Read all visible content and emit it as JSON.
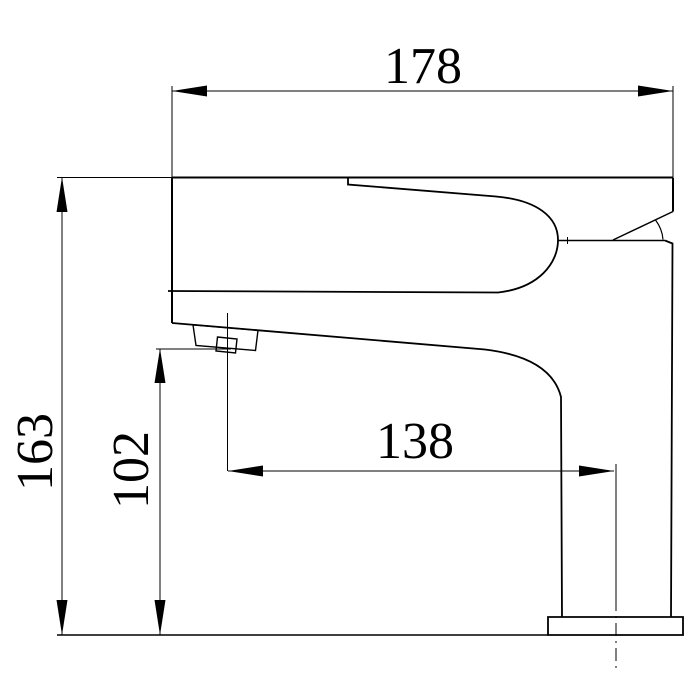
{
  "drawing": {
    "background_color": "#ffffff",
    "line_color": "#000000",
    "dimensions": {
      "overall_width": "178",
      "overall_height": "163",
      "outlet_height": "102",
      "outlet_reach": "138"
    }
  }
}
